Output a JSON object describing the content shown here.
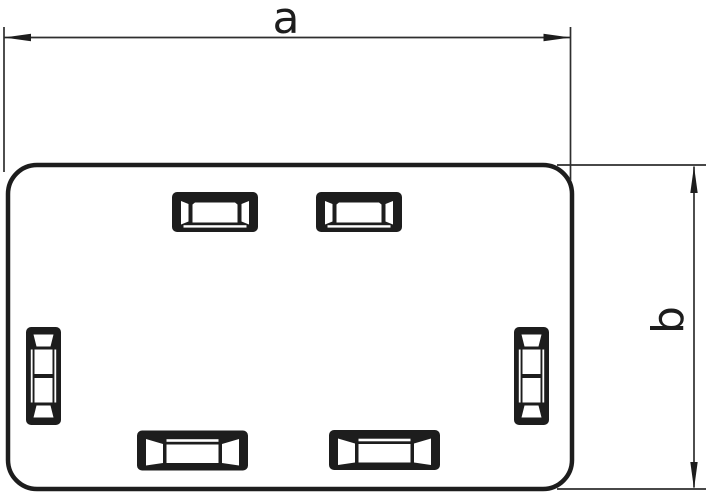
{
  "page": {
    "background": "#ffffff"
  },
  "drawing": {
    "description": "Outline technical drawing of a rounded rectangular end piece with latching slots",
    "stroke_color": "#1d1d1d",
    "thin_line_color": "#2e2e2e",
    "dimension_labels": {
      "a": "a",
      "b": "b"
    },
    "part": {
      "shape": "rounded-rectangle",
      "slot_counts": {
        "top": 2,
        "bottom": 2,
        "left": 1,
        "right": 1
      }
    }
  }
}
